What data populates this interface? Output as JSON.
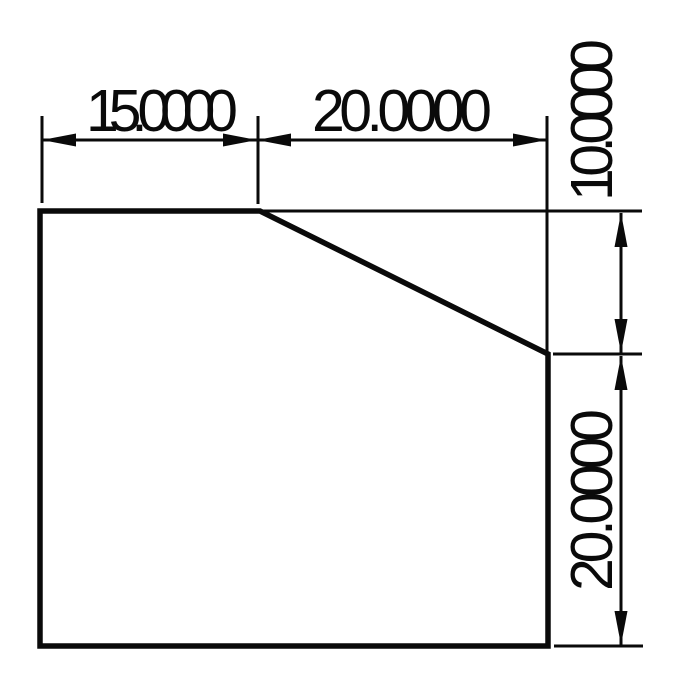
{
  "drawing": {
    "background": "#ffffff",
    "stroke_color": "#0a0a0a",
    "description": "technical-part-drawing-chamfered-rectangle",
    "dimensions": {
      "top_width_left": "15.0000",
      "top_width_right": "20.0000",
      "right_height_upper": "10.0000",
      "right_height_lower": "20.0000"
    }
  }
}
